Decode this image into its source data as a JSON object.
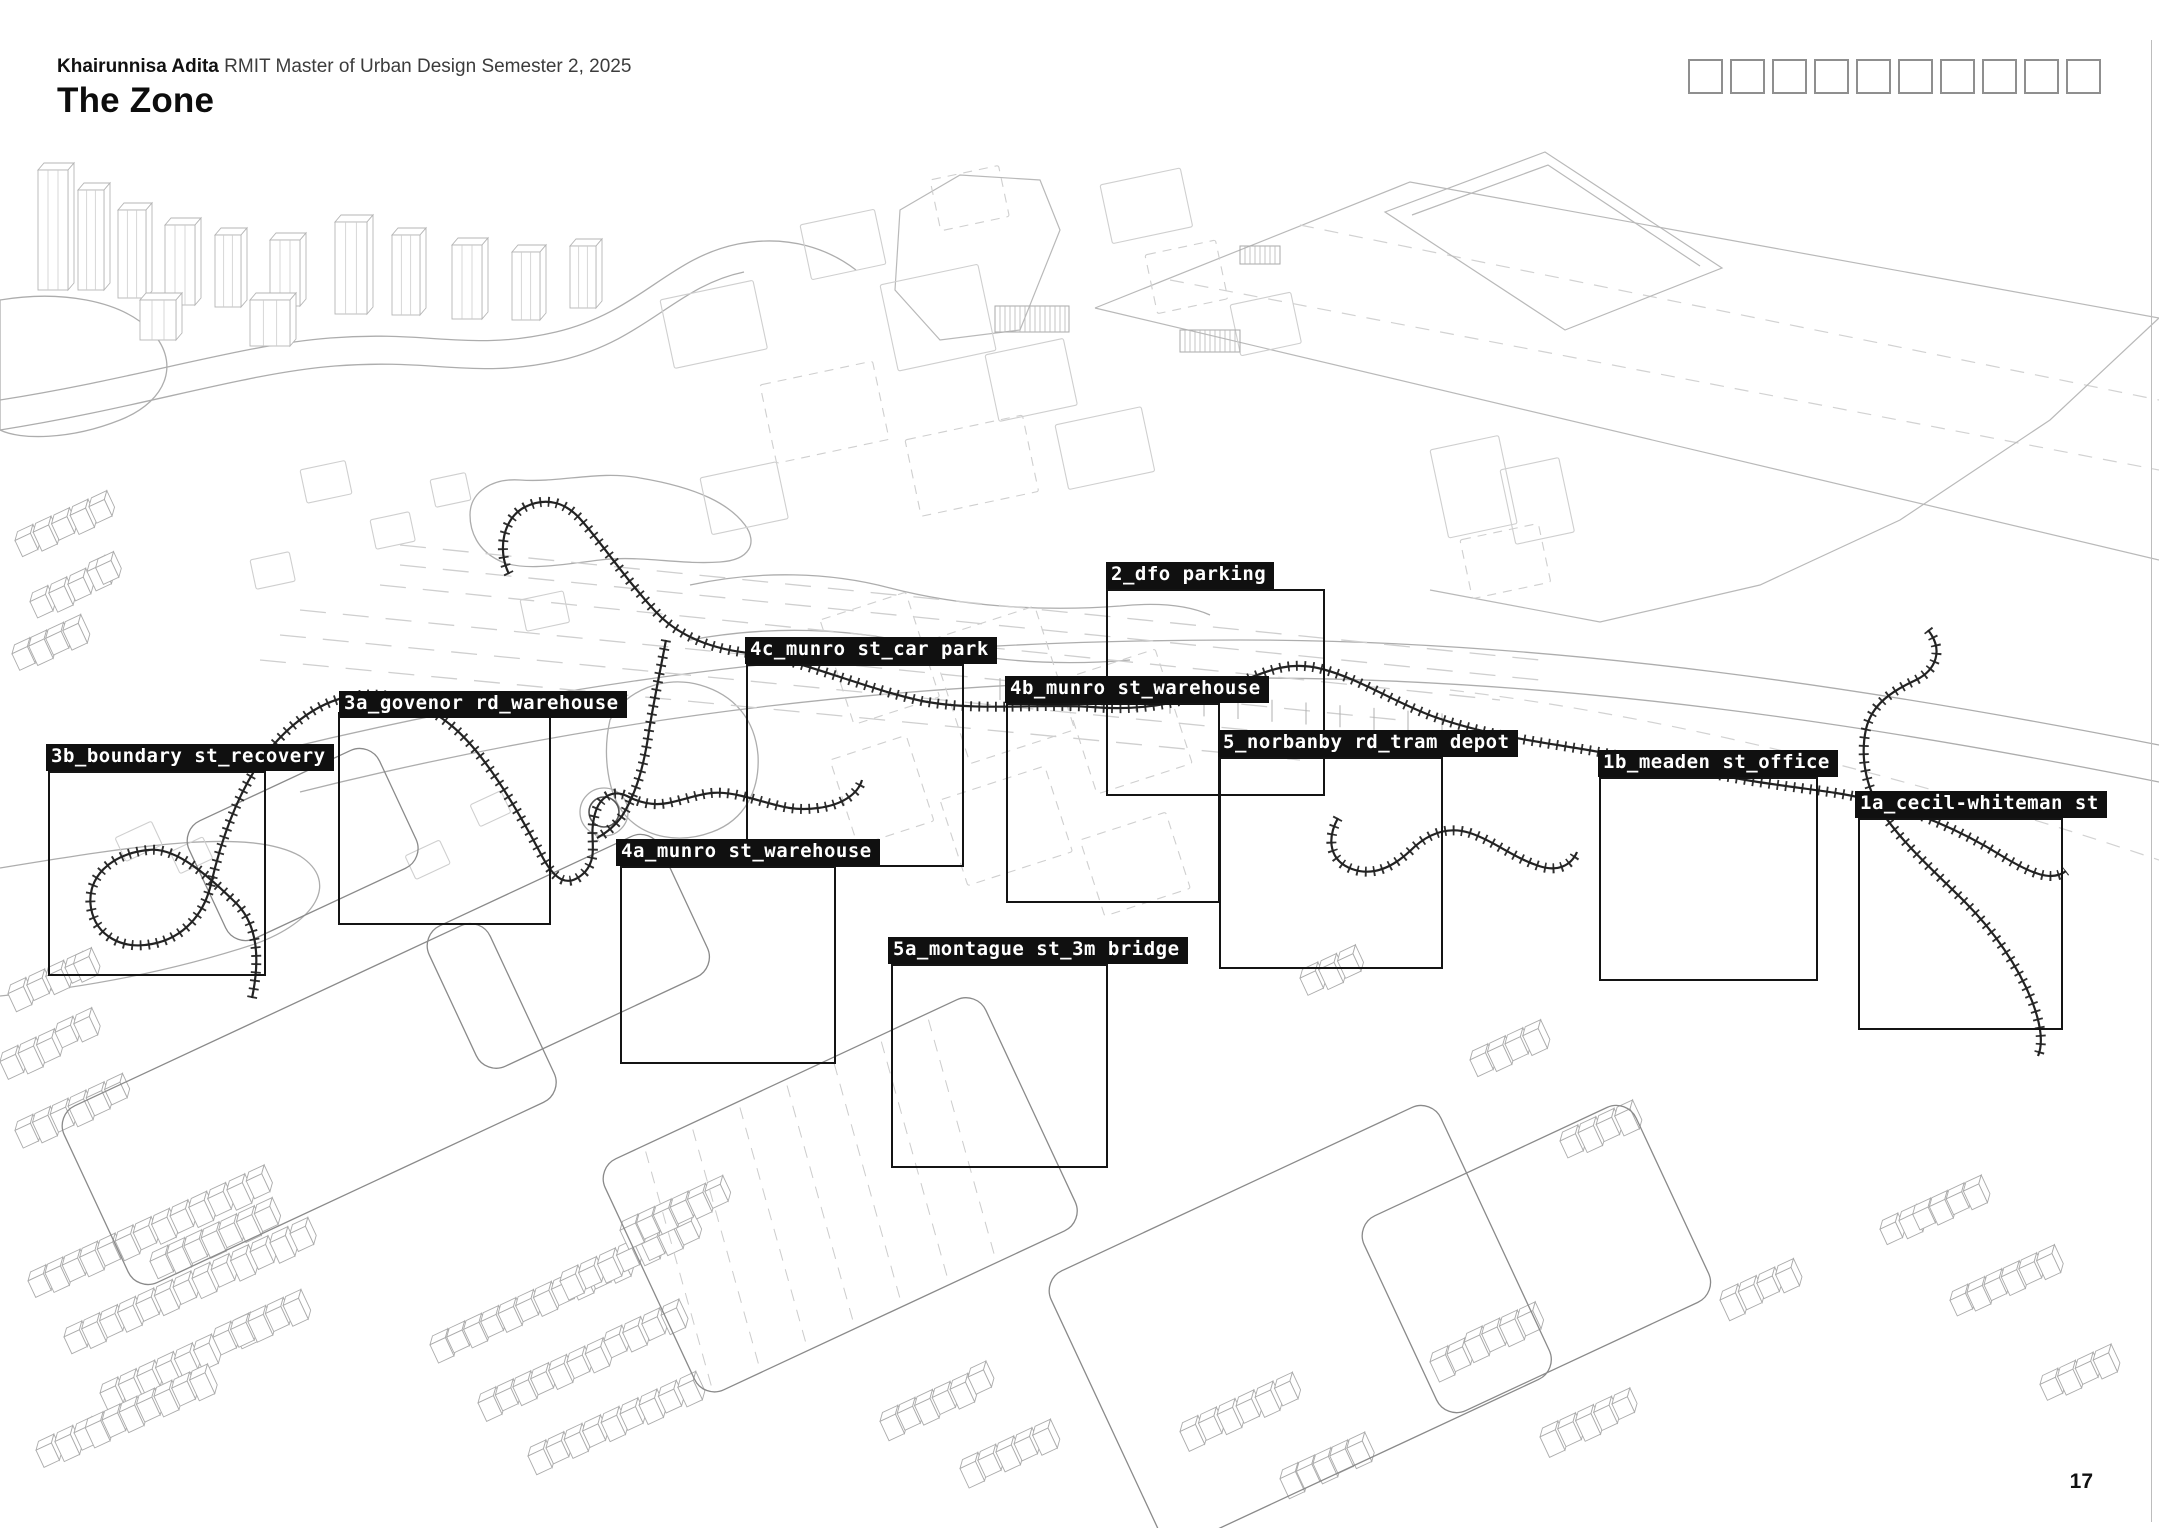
{
  "page": {
    "author": "Khairunnisa Adita",
    "course": "RMIT Master of Urban Design Semester 2, 2025",
    "title": "The Zone",
    "page_number": "17"
  },
  "page_indicators": {
    "count": 10
  },
  "zones": [
    {
      "id": "3b",
      "label": "3b_boundary st_recovery"
    },
    {
      "id": "3a",
      "label": "3a_govenor rd_warehouse"
    },
    {
      "id": "4c",
      "label": "4c_munro st_car park"
    },
    {
      "id": "2",
      "label": "2_dfo parking"
    },
    {
      "id": "4b",
      "label": "4b_munro st_warehouse"
    },
    {
      "id": "5",
      "label": "5_norbanby rd_tram depot"
    },
    {
      "id": "1b",
      "label": "1b_meaden st_office"
    },
    {
      "id": "1a",
      "label": "1a_cecil-whiteman st"
    },
    {
      "id": "4a",
      "label": "4a_munro st_warehouse"
    },
    {
      "id": "5a",
      "label": "5a_montague st_3m bridge"
    }
  ],
  "colors": {
    "label_bg": "#101010",
    "label_text": "#ffffff",
    "zone_outline": "#141414",
    "track": "#1d1d1d",
    "wireframe_light": "#c9c9c9"
  }
}
